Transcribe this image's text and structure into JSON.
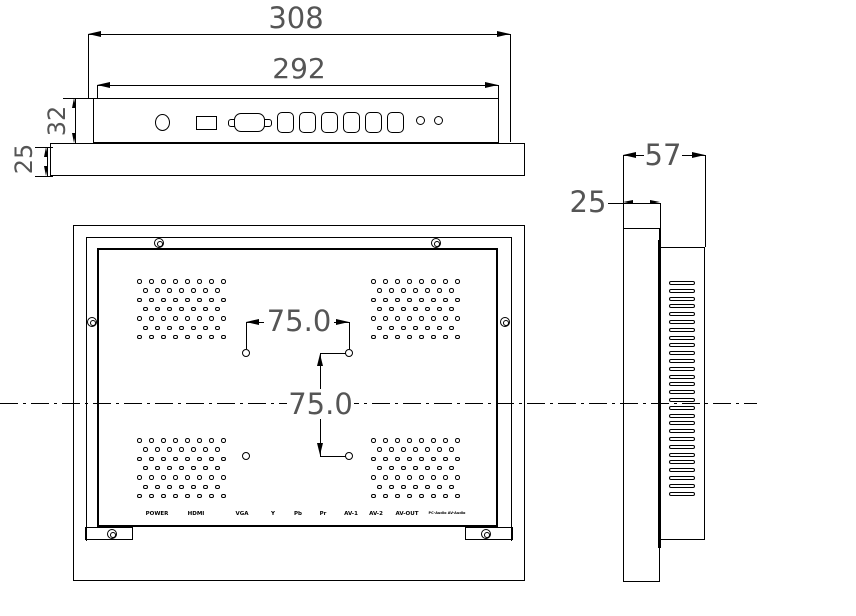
{
  "meta": {
    "type": "technical-drawing",
    "subject": "Open-frame LCD monitor three-view dimensional drawing"
  },
  "dims": {
    "overall_width": "308",
    "panel_width": "292",
    "panel_height": "32",
    "frame_height": "25",
    "vesa_horizontal": "75.0",
    "vesa_vertical": "75.0",
    "depth_total": "57",
    "depth_front": "25"
  },
  "ports": [
    "POWER",
    "HDMI",
    "VGA",
    "Y",
    "Pb",
    "Pr",
    "AV-1",
    "AV-2",
    "AV-OUT",
    "PC-Audio AV-Audio"
  ],
  "colors": {
    "line": "#000000",
    "dim_text": "#555555",
    "background": "#ffffff"
  },
  "patterns": {
    "vent_grid": {
      "rows": 7,
      "cols_even": 8,
      "cols_odd": 7,
      "col_spacing": 12,
      "row_spacing": 9.3,
      "odd_offset": 6,
      "hole_size": 4.5
    },
    "side_slots": {
      "count": 28,
      "spacing": 7.8,
      "width": 26,
      "height": 4
    },
    "round_connectors": {
      "count": 6
    },
    "audio_jacks": {
      "count": 2
    }
  }
}
